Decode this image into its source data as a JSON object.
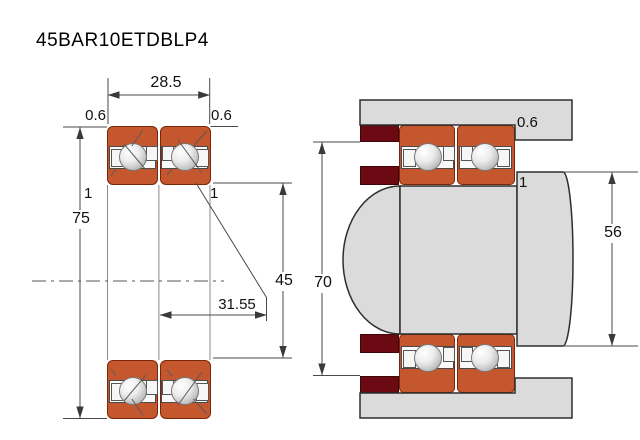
{
  "title": "45BAR10ETDBLP4",
  "left_view": {
    "width": "28.5",
    "outer_diameter": "75",
    "bore_diameter": "45",
    "load_center_distance": "31.55",
    "outer_chamfer_left": "0.6",
    "outer_chamfer_right": "0.6",
    "inner_chamfer_left": "1",
    "inner_chamfer_right": "1"
  },
  "right_view": {
    "spacer_bore_diameter": "70",
    "shaft_shoulder_diameter": "56",
    "housing_chamfer": "0.6",
    "shaft_chamfer": "1"
  },
  "colors": {
    "bearing_ring": "#C5572F",
    "spacer": "#6B0A12",
    "steel": "#DBDBDB"
  }
}
